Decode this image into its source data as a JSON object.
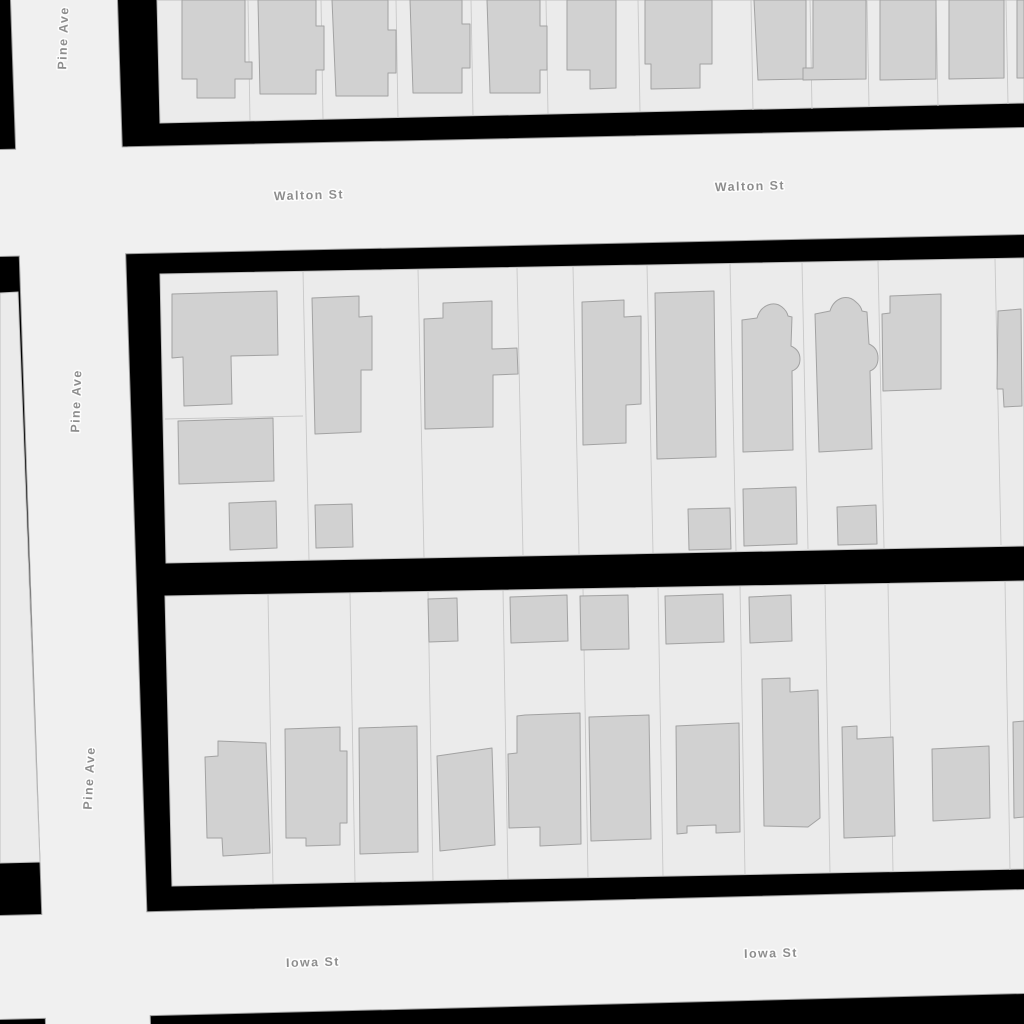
{
  "map": {
    "canvas": {
      "width": 1024,
      "height": 1024
    },
    "colors": {
      "background": "#000000",
      "road_fill": "#f0f0f0",
      "road_casing": "#9a9a9a",
      "block_fill": "#ebebeb",
      "block_stroke": "#bfbfbf",
      "parcel_line": "#c8c8c8",
      "building_fill": "#d1d1d1",
      "building_stroke": "#a2a2a2",
      "label_color": "#8d8d8d",
      "label_halo": "#ffffff"
    },
    "streets": [
      {
        "name": "Pine Ave",
        "orientation": "vertical"
      },
      {
        "name": "Walton St",
        "orientation": "horizontal"
      },
      {
        "name": "Iowa St",
        "orientation": "horizontal"
      }
    ],
    "roads": [
      {
        "id": "road-pine-ave",
        "name": "Pine Ave",
        "points": "11,0 117,0 150,1024 46,1024"
      },
      {
        "id": "road-walton-st",
        "name": "Walton St",
        "points": "0,150 1024,128 1024,234 0,256"
      },
      {
        "id": "road-iowa-st",
        "name": "Iowa St",
        "points": "0,916 1024,890 1024,993 0,1019"
      }
    ],
    "blocks": [
      {
        "id": "block-west-sliver",
        "points": "0,293 18,292 40,862 0,863"
      },
      {
        "id": "block-north",
        "points": "157,0 1024,0 1024,103 160,123"
      },
      {
        "id": "block-middle",
        "points": "160,274 1024,258 1024,546 166,563"
      },
      {
        "id": "block-south",
        "points": "165,596 1024,581 1024,869 172,886"
      }
    ],
    "parcel_lines": [
      {
        "x1": 248,
        "y1": 0,
        "x2": 250,
        "y2": 121
      },
      {
        "x1": 321,
        "y1": 0,
        "x2": 323,
        "y2": 119
      },
      {
        "x1": 396,
        "y1": 0,
        "x2": 398,
        "y2": 118
      },
      {
        "x1": 471,
        "y1": 0,
        "x2": 473,
        "y2": 116
      },
      {
        "x1": 546,
        "y1": 0,
        "x2": 548,
        "y2": 114
      },
      {
        "x1": 638,
        "y1": 0,
        "x2": 640,
        "y2": 112
      },
      {
        "x1": 751,
        "y1": 0,
        "x2": 753,
        "y2": 110
      },
      {
        "x1": 810,
        "y1": 0,
        "x2": 812,
        "y2": 109
      },
      {
        "x1": 867,
        "y1": 0,
        "x2": 869,
        "y2": 107
      },
      {
        "x1": 936,
        "y1": 0,
        "x2": 938,
        "y2": 106
      },
      {
        "x1": 1006,
        "y1": 0,
        "x2": 1008,
        "y2": 104
      },
      {
        "x1": 303,
        "y1": 271,
        "x2": 309,
        "y2": 560
      },
      {
        "x1": 418,
        "y1": 269,
        "x2": 424,
        "y2": 558
      },
      {
        "x1": 517,
        "y1": 268,
        "x2": 523,
        "y2": 555
      },
      {
        "x1": 573,
        "y1": 267,
        "x2": 579,
        "y2": 554
      },
      {
        "x1": 647,
        "y1": 265,
        "x2": 653,
        "y2": 553
      },
      {
        "x1": 730,
        "y1": 264,
        "x2": 736,
        "y2": 551
      },
      {
        "x1": 802,
        "y1": 263,
        "x2": 808,
        "y2": 549
      },
      {
        "x1": 878,
        "y1": 261,
        "x2": 884,
        "y2": 548
      },
      {
        "x1": 995,
        "y1": 259,
        "x2": 1001,
        "y2": 545
      },
      {
        "x1": 165,
        "y1": 419,
        "x2": 303,
        "y2": 416
      },
      {
        "x1": 268,
        "y1": 594,
        "x2": 273,
        "y2": 884
      },
      {
        "x1": 350,
        "y1": 593,
        "x2": 355,
        "y2": 882
      },
      {
        "x1": 428,
        "y1": 591,
        "x2": 433,
        "y2": 881
      },
      {
        "x1": 503,
        "y1": 590,
        "x2": 508,
        "y2": 879
      },
      {
        "x1": 583,
        "y1": 589,
        "x2": 588,
        "y2": 878
      },
      {
        "x1": 658,
        "y1": 587,
        "x2": 663,
        "y2": 876
      },
      {
        "x1": 740,
        "y1": 586,
        "x2": 745,
        "y2": 875
      },
      {
        "x1": 825,
        "y1": 584,
        "x2": 830,
        "y2": 873
      },
      {
        "x1": 888,
        "y1": 583,
        "x2": 893,
        "y2": 872
      },
      {
        "x1": 1005,
        "y1": 581,
        "x2": 1010,
        "y2": 870
      }
    ],
    "buildings": [
      {
        "d": "M182,0 L245,0 L245,62 L252,62 L252,79 L235,79 L235,98 L197,98 L197,79 L182,79 Z"
      },
      {
        "d": "M258,0 L316,0 L316,26 L324,26 L324,70 L316,70 L316,94 L260,94 Z"
      },
      {
        "d": "M332,0 L388,0 L388,30 L396,30 L396,73 L388,73 L388,96 L336,96 Z"
      },
      {
        "d": "M410,0 L462,0 L462,24 L470,24 L470,68 L462,68 L462,93 L413,93 Z"
      },
      {
        "d": "M487,0 L540,0 L540,26 L547,26 L547,70 L540,70 L540,93 L490,93 Z"
      },
      {
        "d": "M567,0 L616,0 L616,88 L590,89 L590,70 L567,70 Z"
      },
      {
        "d": "M645,0 L712,0 L712,64 L700,64 L700,88 L651,89 L651,64 L645,64 Z"
      },
      {
        "d": "M754,0 L806,0 L806,79 L758,80 Z"
      },
      {
        "d": "M813,0 L866,0 L866,79 L803,80 L803,68 L813,68 Z"
      },
      {
        "d": "M880,0 L936,0 L936,79 L880,80 Z"
      },
      {
        "d": "M949,0 L1004,0 L1004,78 L949,79 Z"
      },
      {
        "d": "M1017,0 L1024,0 L1024,78 L1017,78 Z"
      },
      {
        "d": "M172,294 L277,291 L278,355 L231,356 L232,404 L184,406 L183,357 L172,358 Z"
      },
      {
        "d": "M178,421 L273,418 L274,481 L179,484 Z"
      },
      {
        "d": "M229,503 L276,501 L277,548 L230,550 Z"
      },
      {
        "d": "M312,298 L359,296 L359,317 L372,316 L372,370 L361,370 L361,432 L315,434 Z"
      },
      {
        "d": "M315,505 L352,504 L353,547 L316,548 Z"
      },
      {
        "d": "M443,303 L492,301 L492,349 L517,348 L518,374 L493,375 L493,427 L425,429 L424,319 L443,318 Z"
      },
      {
        "d": "M582,302 L624,300 L624,317 L641,316 L641,404 L626,405 L626,443 L583,445 Z"
      },
      {
        "d": "M655,293 L714,291 L716,457 L657,459 Z"
      },
      {
        "d": "M742,320 L757,318 Q760,308 768,305 Q776,302 782,307 Q787,311 788,316 L792,317 L791,346 Q800,350 800,359 Q800,368 792,371 L793,450 L743,452 Z"
      },
      {
        "d": "M815,314 L830,311 Q833,301 842,298 Q850,296 856,302 Q861,306 862,311 L867,312 L869,344 Q878,348 878,358 Q878,368 870,371 L872,449 L819,452 Z"
      },
      {
        "d": "M688,509 L730,508 L731,549 L689,550 Z"
      },
      {
        "d": "M743,489 L796,487 L797,544 L744,546 Z"
      },
      {
        "d": "M837,507 L876,505 L877,544 L838,545 Z"
      },
      {
        "d": "M890,296 L941,294 L941,389 L883,391 L882,314 L890,313 Z"
      },
      {
        "d": "M998,311 L1021,309 L1022,406 L1004,407 L1003,389 L997,389 Z"
      },
      {
        "d": "M218,741 L266,743 L270,853 L223,856 L222,838 L207,838 L205,757 L218,756 Z"
      },
      {
        "d": "M285,729 L340,727 L340,751 L347,751 L347,823 L340,823 L340,845 L306,846 L306,838 L286,838 Z"
      },
      {
        "d": "M359,728 L417,726 L418,852 L360,854 Z"
      },
      {
        "d": "M428,599 L457,598 L458,641 L429,642 Z"
      },
      {
        "d": "M437,756 L492,748 L495,845 L440,851 Z"
      },
      {
        "d": "M510,597 L567,595 L568,641 L511,643 Z"
      },
      {
        "d": "M525,715 L580,713 L581,844 L540,846 L540,827 L509,828 L508,754 L517,753 L517,716 Z"
      },
      {
        "d": "M580,596 L628,595 L629,649 L581,650 Z"
      },
      {
        "d": "M589,717 L649,715 L651,839 L591,841 Z"
      },
      {
        "d": "M665,596 L723,594 L724,642 L666,644 Z"
      },
      {
        "d": "M676,726 L739,723 L740,832 L716,833 L716,825 L687,826 L687,833 L677,834 Z"
      },
      {
        "d": "M749,597 L791,595 L792,641 L750,643 Z"
      },
      {
        "d": "M762,679 L790,678 L790,692 L818,690 L820,818 L808,827 L764,826 Z"
      },
      {
        "d": "M842,727 L857,726 L857,739 L893,737 L895,836 L844,838 Z"
      },
      {
        "d": "M932,749 L989,746 L990,818 L933,821 Z"
      },
      {
        "d": "M1013,722 L1024,721 L1024,817 L1014,818 Z"
      }
    ],
    "labels": [
      {
        "text": "Walton St",
        "x": 309,
        "y": 196,
        "rotate": -1.5
      },
      {
        "text": "Walton St",
        "x": 750,
        "y": 187,
        "rotate": -1.5
      },
      {
        "text": "Iowa St",
        "x": 313,
        "y": 963,
        "rotate": -1.5
      },
      {
        "text": "Iowa St",
        "x": 771,
        "y": 954,
        "rotate": -1.2
      },
      {
        "text": "Pine Ave",
        "x": 64,
        "y": 38,
        "rotate": -88
      },
      {
        "text": "Pine Ave",
        "x": 77,
        "y": 401,
        "rotate": -88
      },
      {
        "text": "Pine Ave",
        "x": 90,
        "y": 778,
        "rotate": -87
      }
    ]
  }
}
